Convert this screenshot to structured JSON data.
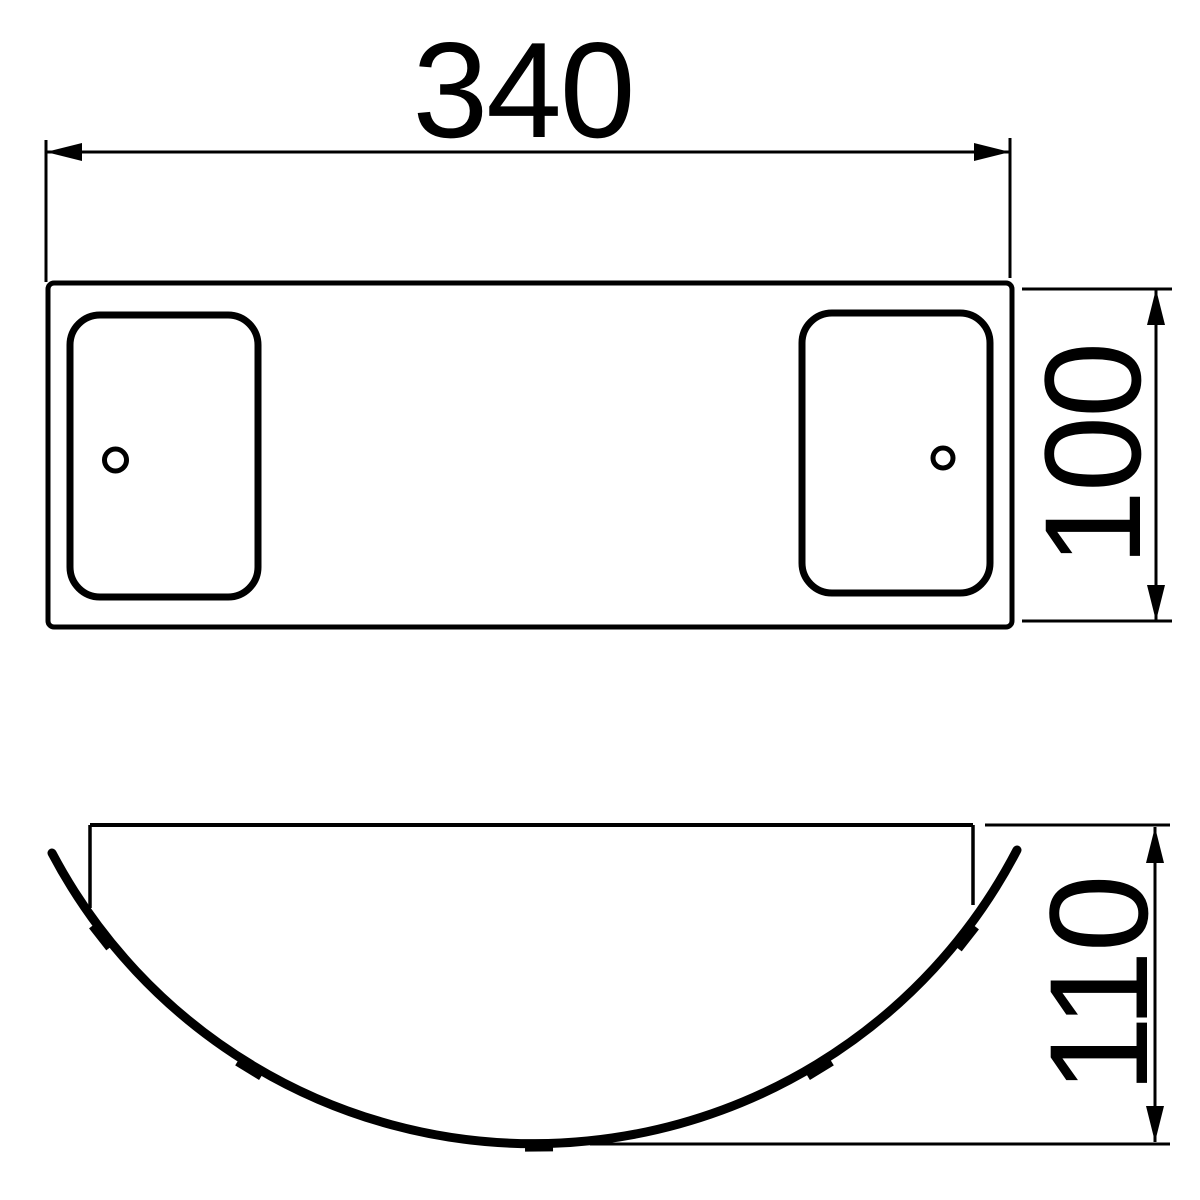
{
  "drawing": {
    "width_label": "340",
    "depth_label": "100",
    "height_label": "110",
    "ink_color": "#000000",
    "paper_color": "#ffffff"
  }
}
